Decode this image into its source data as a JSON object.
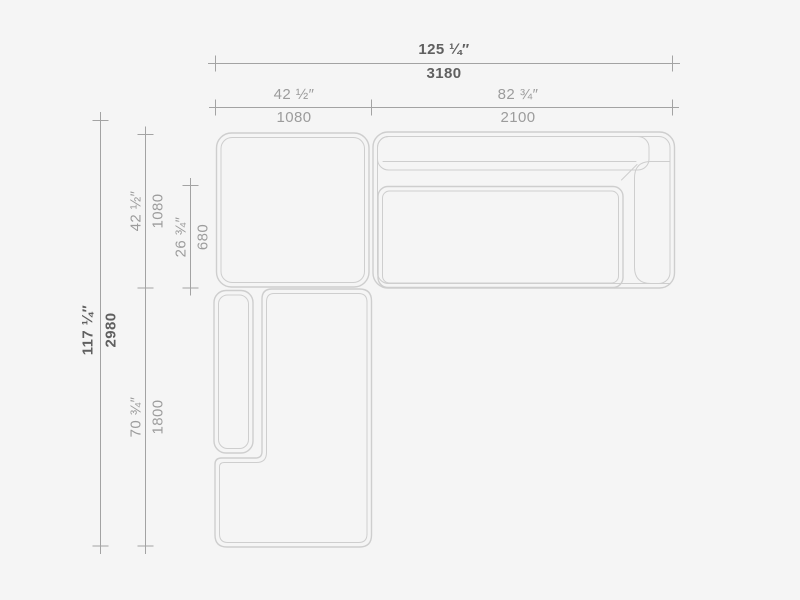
{
  "colors": {
    "background": "#f5f5f5",
    "furniture_outline": "#cecece",
    "dimension_line": "#a3a3a3",
    "dimension_text": "#9c9c9c",
    "dimension_text_emphasis": "#606060"
  },
  "dims": {
    "h": [
      {
        "name": "overall-width",
        "inches": "125 ¼″",
        "mm": "3180",
        "bold": true
      },
      {
        "name": "corner-module-width",
        "inches": "42 ½″",
        "mm": "1080",
        "bold": false
      },
      {
        "name": "sofa-module-width",
        "inches": "82 ¾″",
        "mm": "2100",
        "bold": false
      }
    ],
    "v": [
      {
        "name": "overall-depth",
        "inches": "117 ¼″",
        "mm": "2980",
        "bold": true
      },
      {
        "name": "top-section-depth",
        "inches": "42 ½″",
        "mm": "1080",
        "bold": false
      },
      {
        "name": "seat-depth",
        "inches": "26 ¾″",
        "mm": "680",
        "bold": false
      },
      {
        "name": "chaise-length",
        "inches": "70 ¾″",
        "mm": "1800",
        "bold": false
      }
    ]
  }
}
